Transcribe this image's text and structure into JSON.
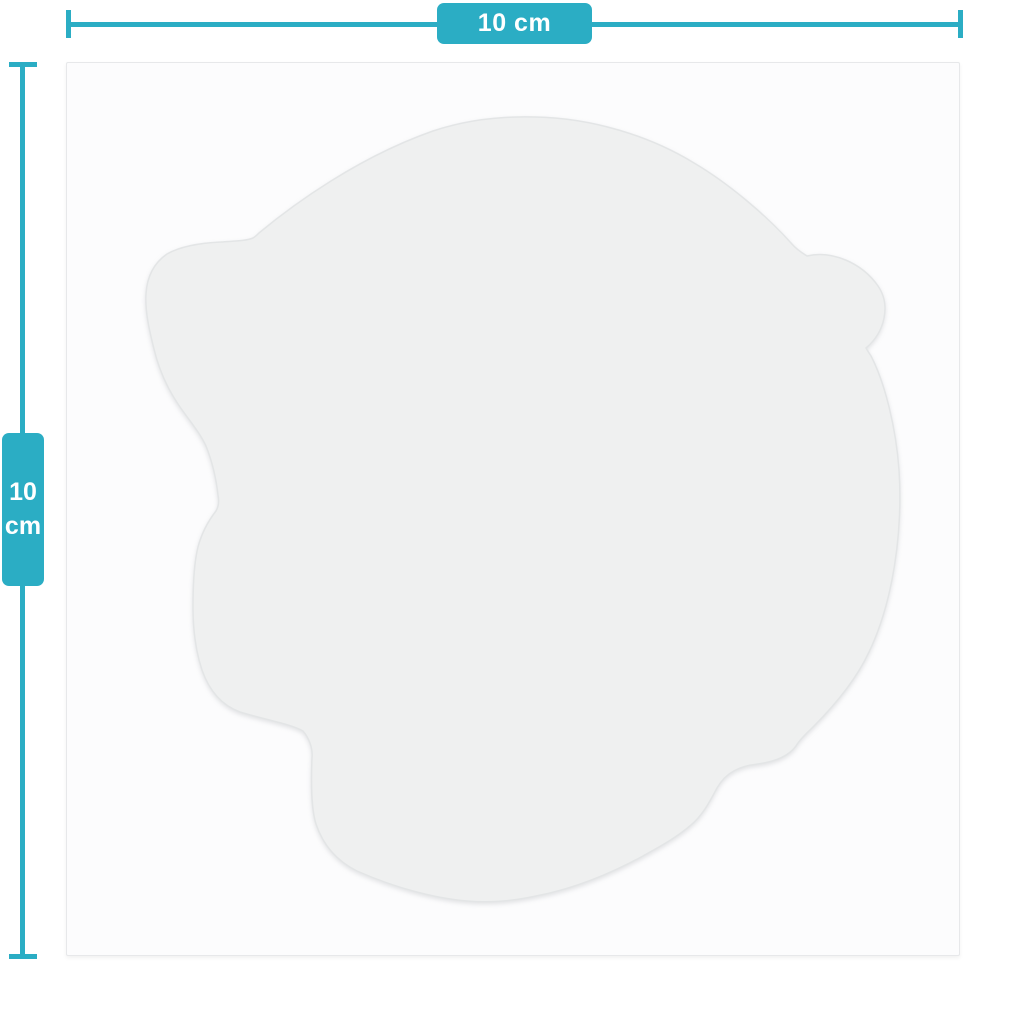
{
  "colors": {
    "accent": "#2badc4",
    "page_bg": "#ffffff",
    "card_bg": "#fcfcfd",
    "card_border": "#e7e8ea",
    "silhouette_fill": "#eff0f0",
    "silhouette_edge": "#e3e5e6",
    "label_text": "#ffffff"
  },
  "dimensions": {
    "width": {
      "label": "10 cm",
      "value": "10",
      "unit": "cm"
    },
    "height": {
      "value": "10",
      "unit": "cm"
    }
  },
  "silhouette": {
    "icon": "animal-head-die-cut-silhouette"
  }
}
